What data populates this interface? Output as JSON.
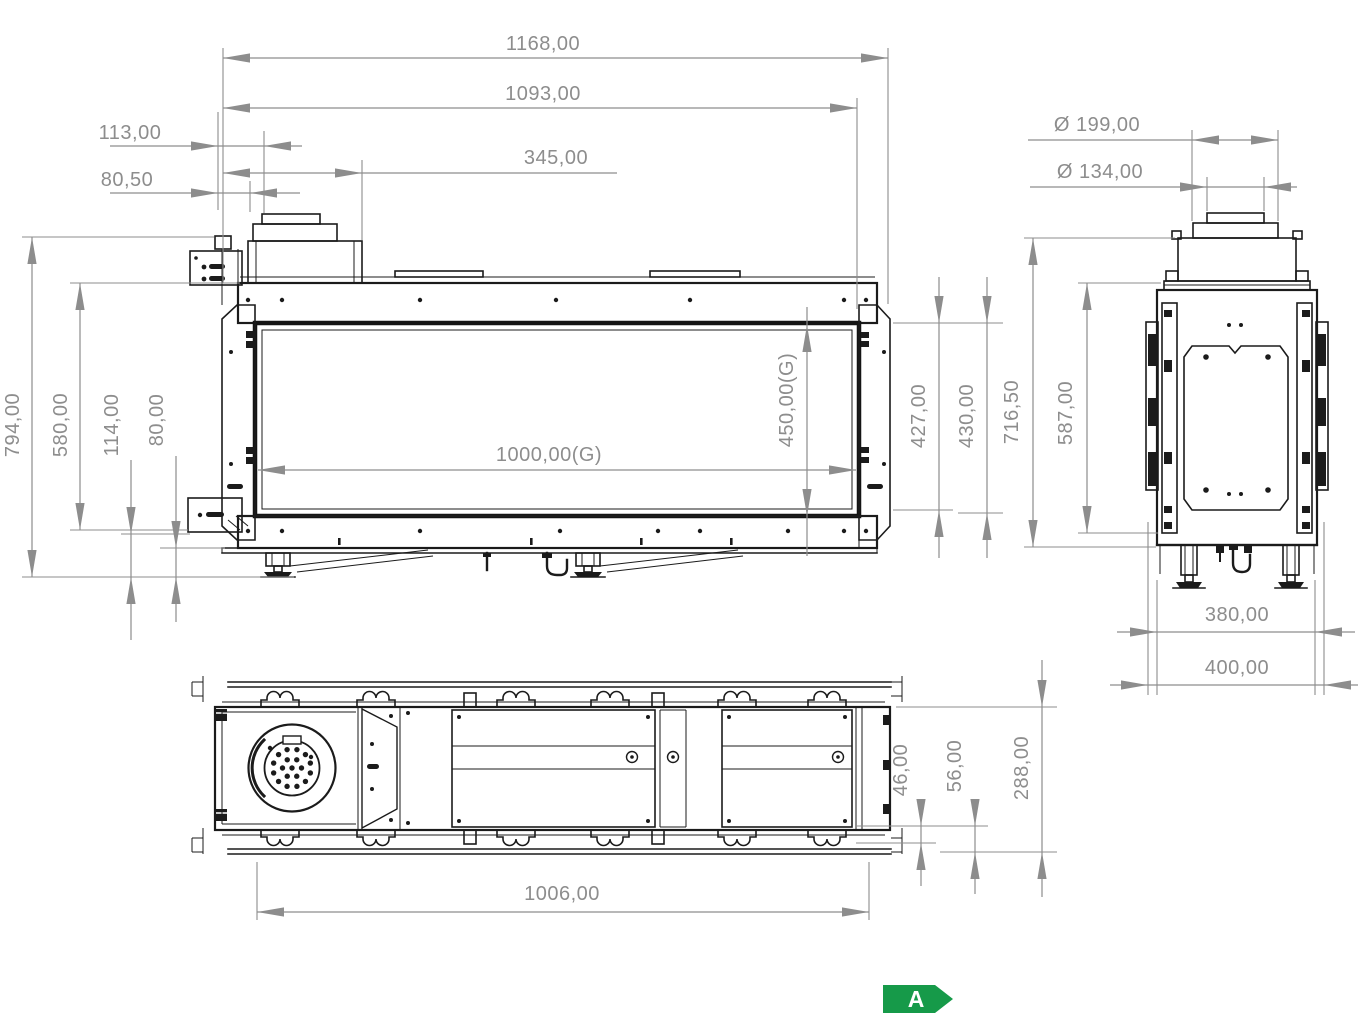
{
  "drawing": {
    "title": "fireplace-technical-drawing",
    "dims": {
      "w1168": "1168,00",
      "w1093": "1093,00",
      "w113": "113,00",
      "w345": "345,00",
      "w80_5": "80,50",
      "d199": "Ø 199,00",
      "d134": "Ø 134,00",
      "h794": "794,00",
      "h580": "580,00",
      "h114": "114,00",
      "h80": "80,00",
      "g1000": "1000,00(G)",
      "g450": "450,00(G)",
      "h427": "427,00",
      "h430": "430,00",
      "h716": "716,50",
      "h587": "587,00",
      "w380": "380,00",
      "w400": "400,00",
      "h46": "46,00",
      "h56": "56,00",
      "h288": "288,00",
      "w1006": "1006,00"
    },
    "energy": {
      "label": "A",
      "color": "#169a49",
      "text_color": "#ffffff"
    },
    "colors": {
      "line": "#1b1b1b",
      "dimension": "#8d8d8d",
      "background": "#ffffff"
    }
  }
}
